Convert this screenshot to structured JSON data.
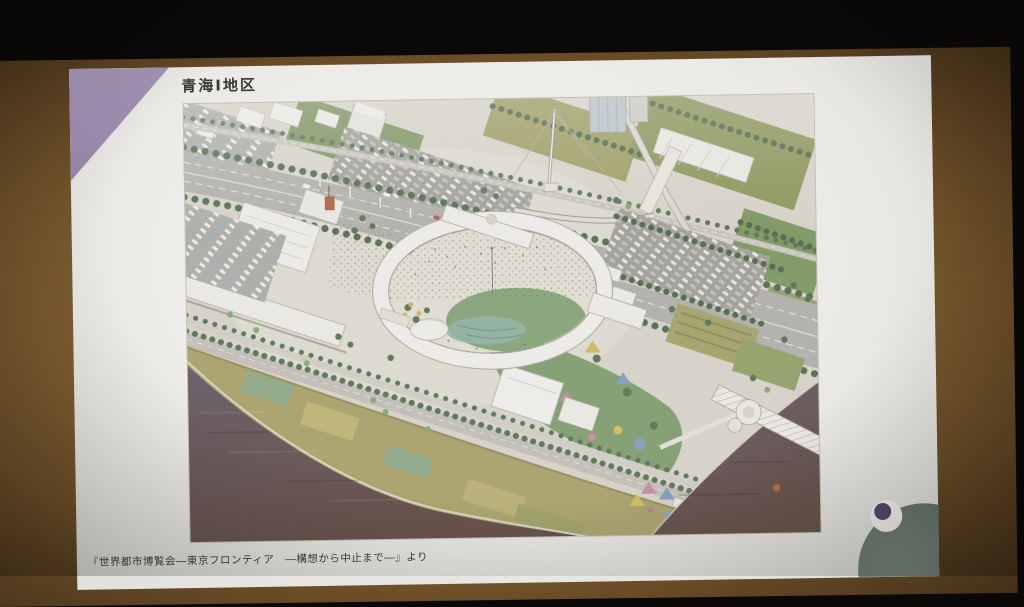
{
  "slide": {
    "title": "青海Ⅰ地区",
    "caption": "『世界都市博覧会―東京フロンティア　―構想から中止まで―』より",
    "accent_color": "#a08db2",
    "background_color": "#ebeae6"
  },
  "illustration": {
    "type": "aerial-rendering",
    "subject": "青海Ⅰ地区",
    "colors": {
      "water": "#6a5c6b",
      "water_shadow": "#694c41",
      "parkland": "#b0a65f",
      "greenery": "#5a7850",
      "roads": "#b6b4ae",
      "buildings": "#f3f1eb",
      "ring_building": "#f4f2ec"
    }
  },
  "mascot": {
    "name": "eyeball-character",
    "body_color": "#6e7d74",
    "eye_color": "#f3f2ec",
    "pupil_color": "#57496a"
  },
  "room": {
    "wall_color": "#8a6639",
    "ceiling_color": "#0b0908"
  }
}
